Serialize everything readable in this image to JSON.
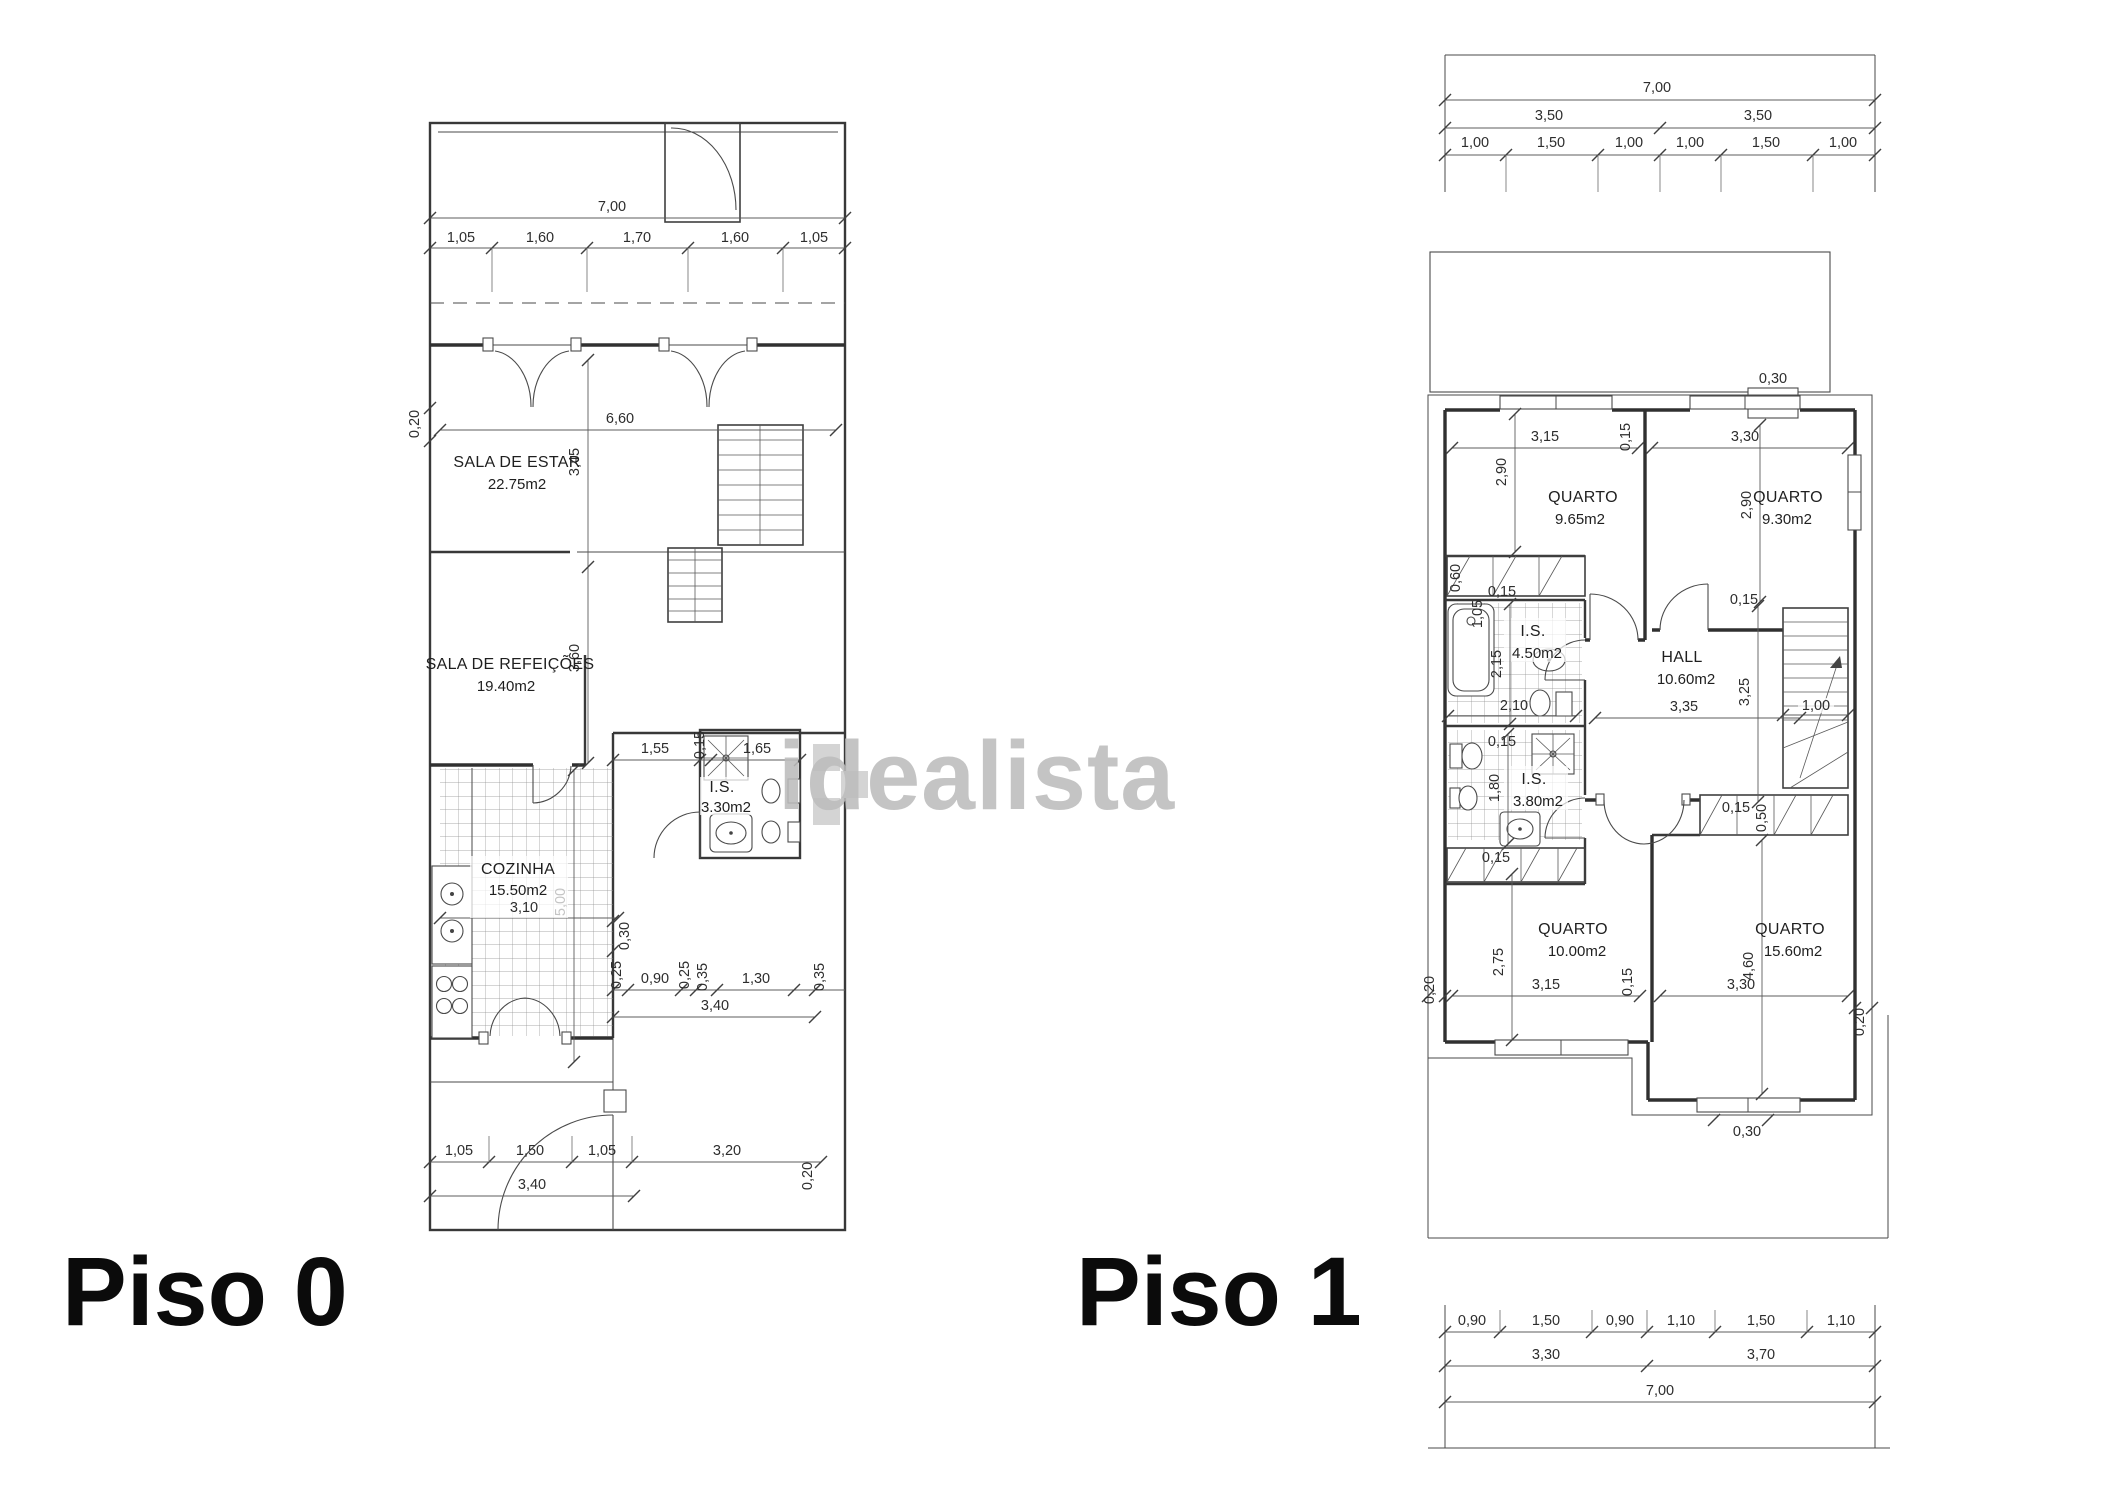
{
  "watermark": {
    "text": "idealista"
  },
  "piso0": {
    "label": "Piso 0",
    "rooms": {
      "sala_estar": {
        "name": "SALA DE ESTAR",
        "area": "22.75m2"
      },
      "sala_refeicoes": {
        "name": "SALA DE REFEIÇÕES",
        "area": "19.40m2"
      },
      "cozinha": {
        "name": "COZINHA",
        "area": "15.50m2"
      },
      "is": {
        "name": "I.S.",
        "area": "3.30m2"
      }
    },
    "dims": {
      "total_width": "7,00",
      "front_row": [
        "1,05",
        "1,60",
        "1,70",
        "1,60",
        "1,05"
      ],
      "wall_side": "0,20",
      "sala_width": "6,60",
      "sala_depth": "3,45",
      "refeicoes_depth": "3,60",
      "cozinha_width": "3,10",
      "cozinha_depth": "5,00",
      "d030": "0,30",
      "d025": "0,25",
      "d090": "0,90",
      "d035": "0,35",
      "d130": "1,30",
      "hall_width": "1,55",
      "d015": "0,15",
      "is_width": "1,65",
      "entry_total": "3,40",
      "back_row": [
        "1,05",
        "1,50",
        "1,05"
      ],
      "back_right": "3,20",
      "back_total": "3,40",
      "wall_back": "0,20"
    }
  },
  "piso1": {
    "label": "Piso 1",
    "rooms": {
      "quarto1": {
        "name": "QUARTO",
        "area": "9.65m2"
      },
      "quarto2": {
        "name": "QUARTO",
        "area": "9.30m2"
      },
      "hall": {
        "name": "HALL",
        "area": "10.60m2"
      },
      "is1": {
        "name": "I.S.",
        "area": "4.50m2"
      },
      "is2": {
        "name": "I.S.",
        "area": "3.80m2"
      },
      "quarto3": {
        "name": "QUARTO",
        "area": "10.00m2"
      },
      "quarto4": {
        "name": "QUARTO",
        "area": "15.60m2"
      }
    },
    "dims": {
      "total_width": "7,00",
      "half_row": [
        "3,50",
        "3,50"
      ],
      "front_row": [
        "1,00",
        "1,50",
        "1,00",
        "1,00",
        "1,50",
        "1,00"
      ],
      "deck_step": "0,30",
      "q1_width": "3,15",
      "q1_depth": "2,90",
      "q2_width": "3,30",
      "q2_depth": "2,90",
      "q3_width": "3,15",
      "q3_depth": "2,75",
      "q4_width": "3,30",
      "q4_depth": "4,60",
      "hall_width": "3,35",
      "hall_depth": "3,25",
      "stair_width": "1,00",
      "bath1_width": "2,10",
      "bath1_depth": "2,15",
      "bath2_depth": "1,80",
      "d015": "0,15",
      "d020": "0,20",
      "d030": "0,30",
      "d050": "0,50",
      "d060": "0,60",
      "d105": "1,05",
      "back_row": [
        "0,90",
        "1,50",
        "0,90",
        "1,10",
        "1,50",
        "1,10"
      ],
      "back_half_row": [
        "3,30",
        "3,70"
      ],
      "back_total": "7,00"
    }
  }
}
